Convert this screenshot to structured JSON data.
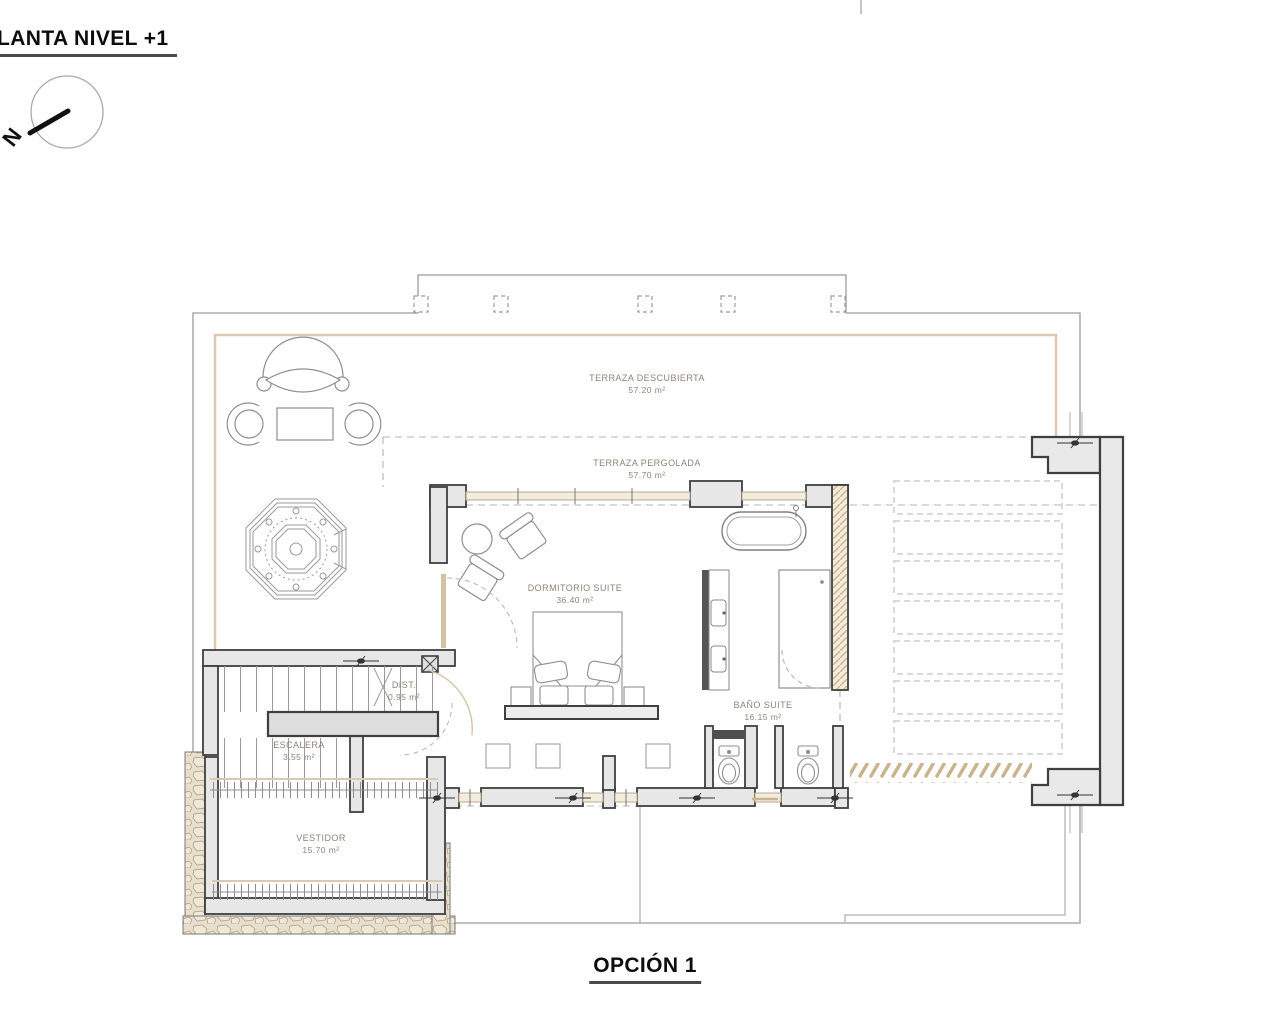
{
  "page": {
    "title": "LANTA NIVEL +1",
    "option": "OPCIÓN 1",
    "compass_n": "N"
  },
  "rooms": {
    "terraza_descubierta": {
      "name": "TERRAZA DESCUBIERTA",
      "area": "57.20 m²"
    },
    "terraza_pergolada": {
      "name": "TERRAZA PERGOLADA",
      "area": "57.70 m²"
    },
    "dormitorio_suite": {
      "name": "DORMITORIO SUITE",
      "area": "36.40 m²"
    },
    "bano_suite": {
      "name": "BAÑO SUITE",
      "area": "16.15 m²"
    },
    "dist": {
      "name": "DIST.",
      "area": "0.95 m²"
    },
    "escalera": {
      "name": "ESCALERA",
      "area": "3.55 m²"
    },
    "vestidor": {
      "name": "VESTIDOR",
      "area": "15.70 m²"
    }
  },
  "colors": {
    "wall_dark": "#3f3f3f",
    "wall_fill": "#e7e7e7",
    "edge_beige": "#d8c9b0",
    "louver_tan": "#c9b48d",
    "outline_gray": "#9c9c9c"
  }
}
